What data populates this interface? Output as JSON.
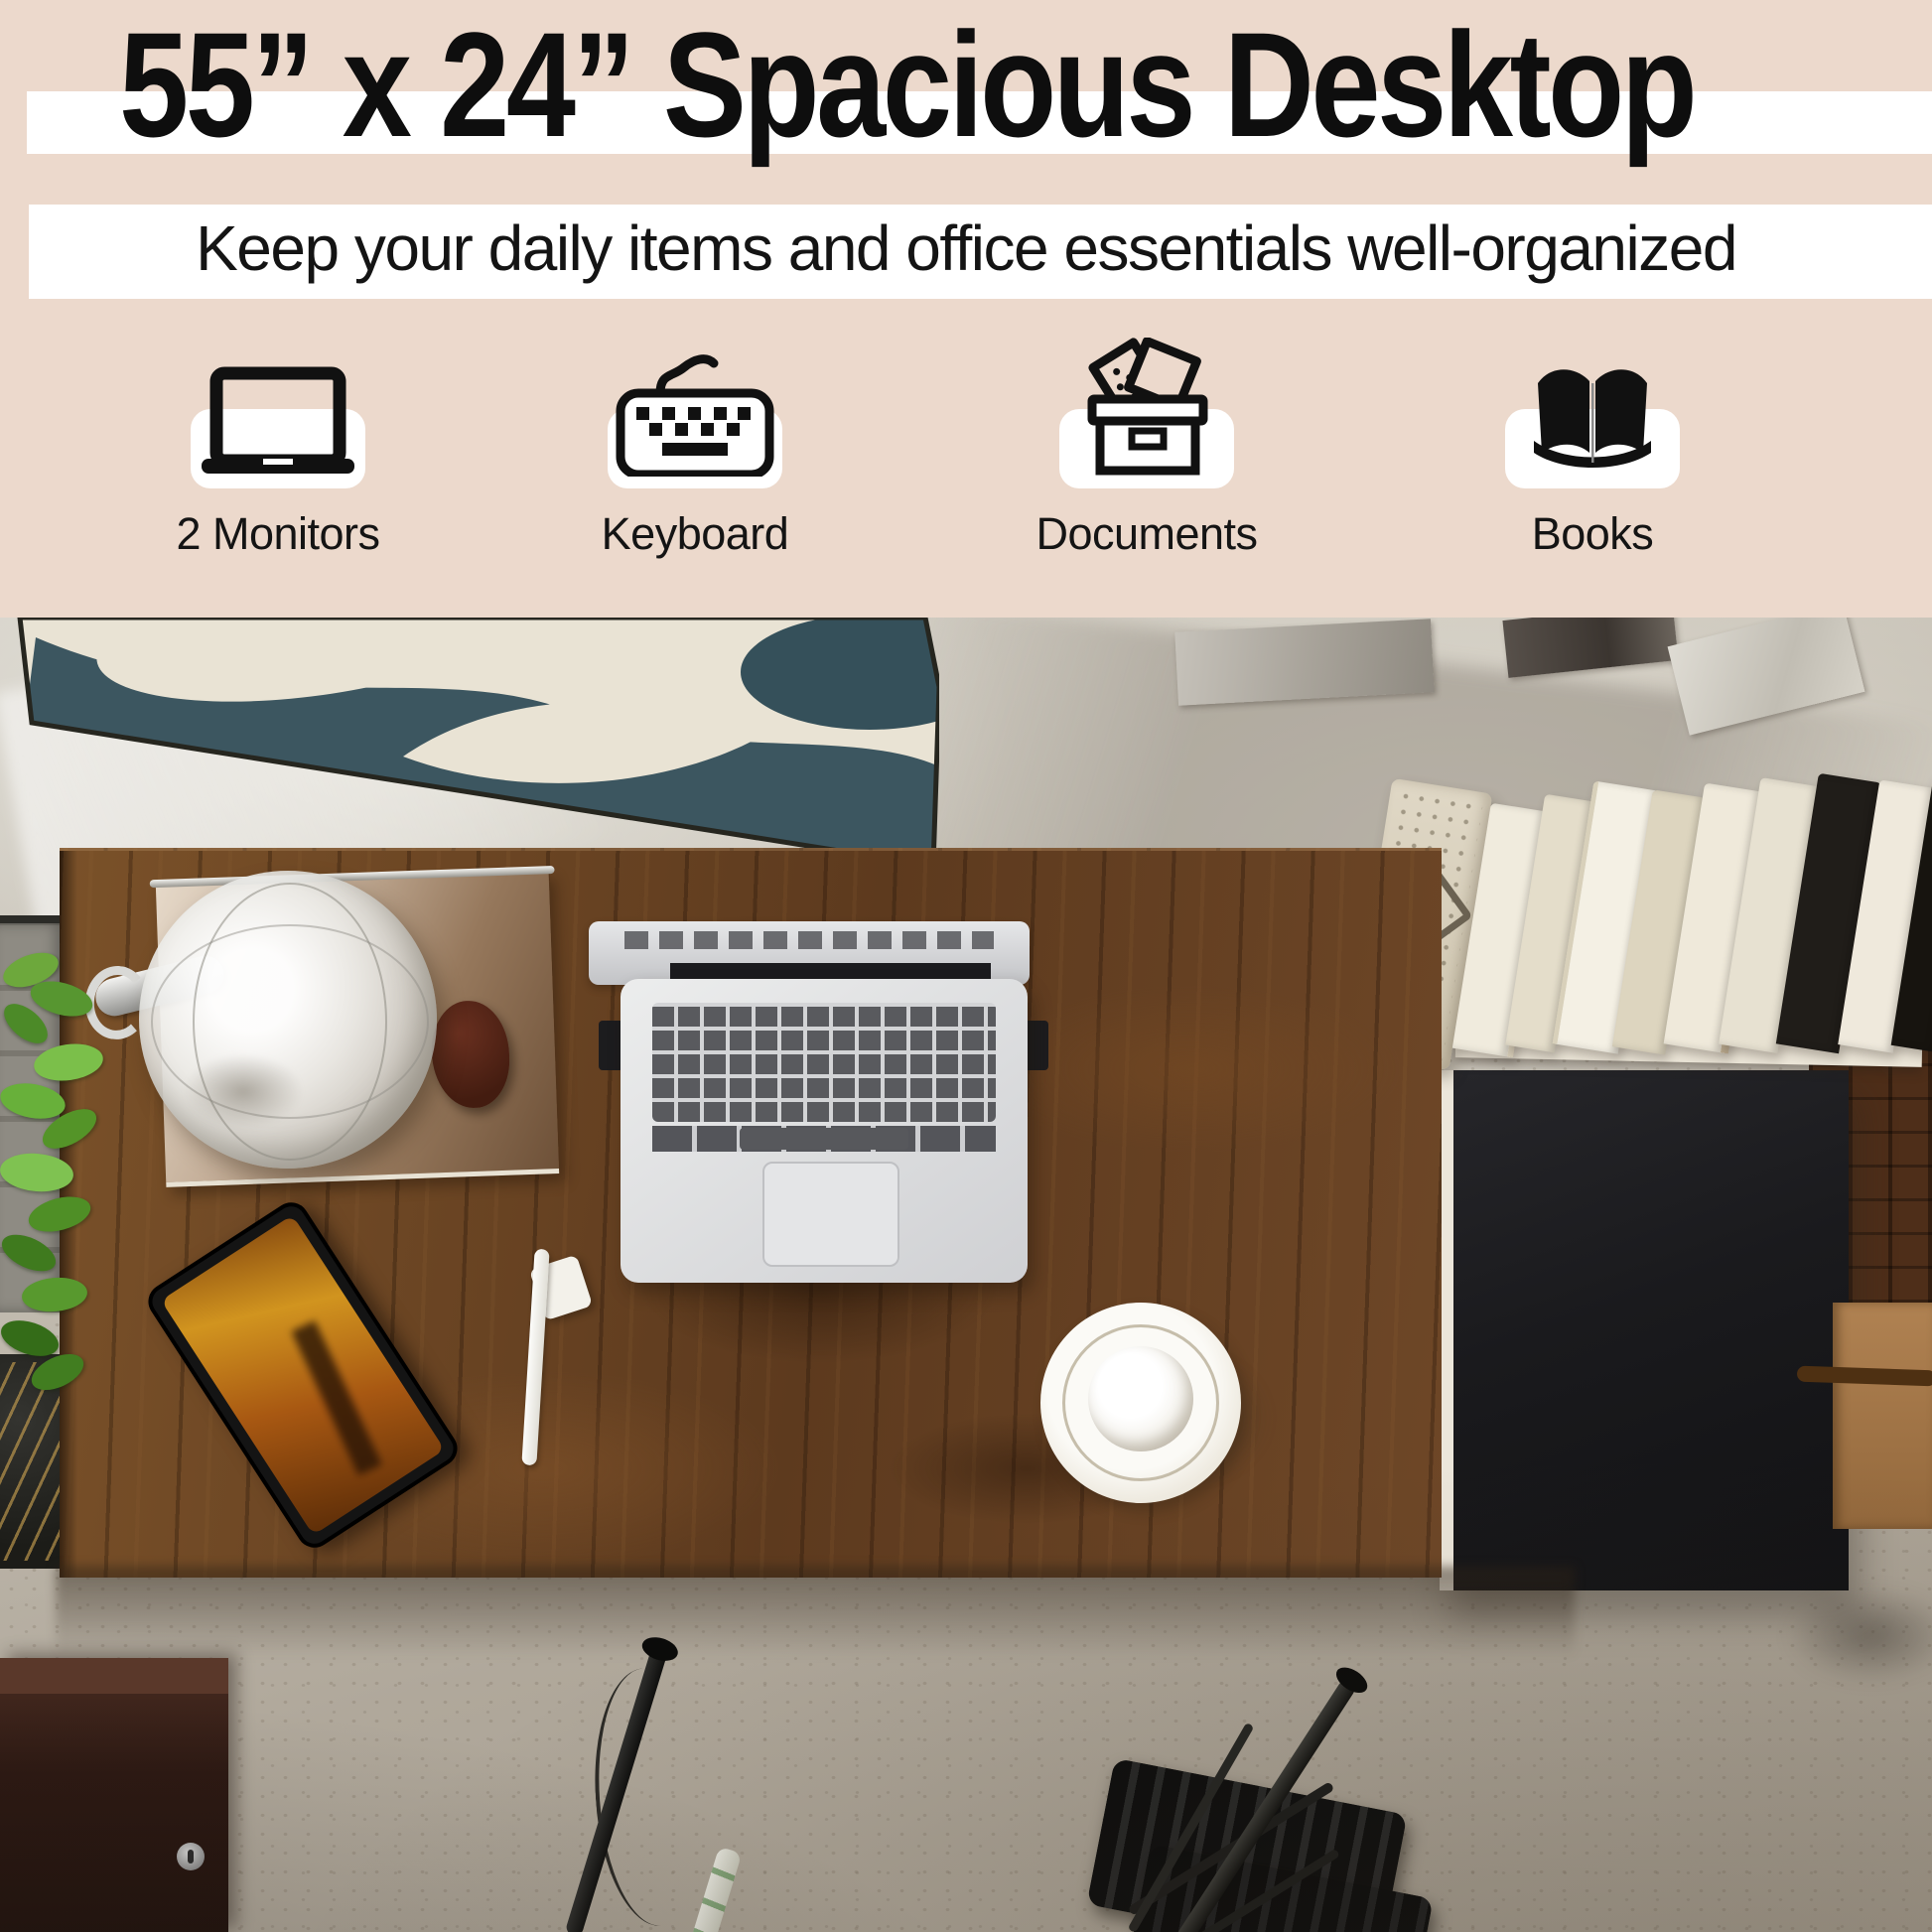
{
  "header": {
    "title": "55” x 24” Spacious Desktop",
    "subtitle": "Keep your daily items and office essentials well-organized",
    "banner_color": "#ffffff",
    "background_color": "#ecd9cc",
    "text_color": "#0e0e0e"
  },
  "features": {
    "tile_color": "#ffffff",
    "icon_color": "#111111",
    "items": [
      {
        "icon": "laptop-icon",
        "label": "2 Monitors"
      },
      {
        "icon": "keyboard-icon",
        "label": "Keyboard"
      },
      {
        "icon": "documents-box-icon",
        "label": "Documents"
      },
      {
        "icon": "open-book-icon",
        "label": "Books"
      }
    ]
  },
  "photo": {
    "palette": {
      "desk_wood_brown": "#6b4628",
      "desk_return_black": "#1a1a1d",
      "concrete_floor_gray": "#b5ada0",
      "wall_art_teal": "#3c5660",
      "wall_art_cream": "#e9e3d4",
      "books_cream": "#efe9da",
      "plant_green": "#5f9c33",
      "phone_screen_amber": "#a85812",
      "cup_white": "#fbfaf6"
    }
  }
}
